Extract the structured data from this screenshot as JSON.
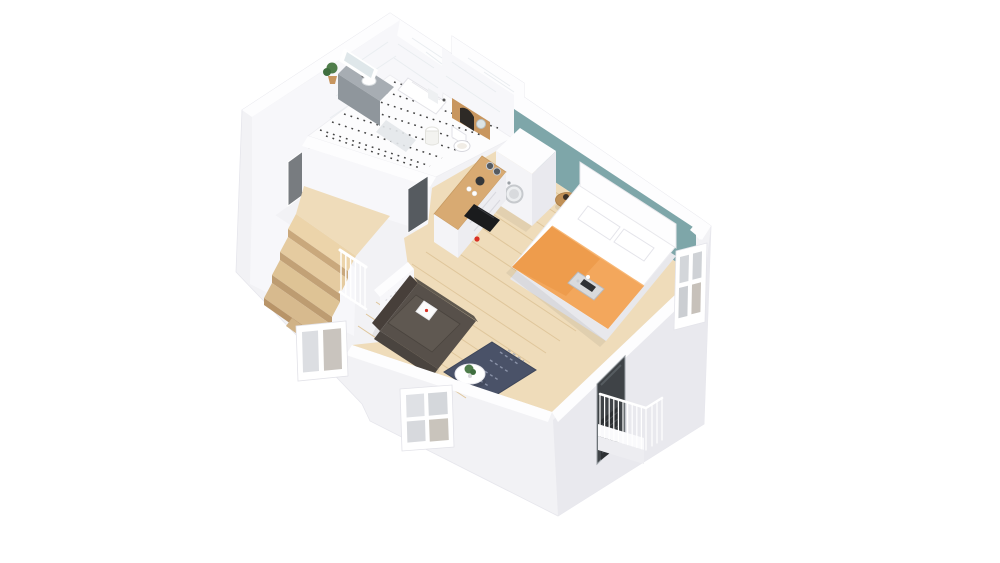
{
  "scene": {
    "kind": "3d-floor-plan-render",
    "view": "isometric dollhouse cutaway of a studio apartment, viewed from above",
    "background": "#ffffff"
  },
  "colors": {
    "wall_white": "#fdfdfe",
    "wall_light": "#f2f2f5",
    "wall_face": "#f7f7fa",
    "wall_shade": "#e9e9ee",
    "teal_wall": "#7ea6a9",
    "wood_floor": "#efdcba",
    "plank_line": "#dfc69b",
    "counter_wood": "#d8aa72",
    "niche_wood": "#c8965f",
    "table_wood": "#c09056",
    "stair_wood": "#e8cfa5",
    "stair_riser": "#c9a87c",
    "duvet_orange": "#f3a75c",
    "duvet_fold": "#e99440",
    "mattress_white": "#ffffff",
    "sofa_body": "#57504a",
    "sofa_seat": "#5f5851",
    "sofa_dark": "#473f3a",
    "rug_navy": "#4a5268",
    "rug_pattern": "#9aa2b8",
    "red_accent": "#d93025",
    "cooktop_black": "#1a1b1d",
    "door_gray": "#787c80",
    "door_dark": "#565b60",
    "balcony_door": "#3f4347",
    "glass_gray": "#d4d7db",
    "vanity_top": "#a7adb3",
    "vanity_front": "#8f969c",
    "plant_green": "#4f7d4b",
    "tile_dot": "#222222"
  },
  "rooms": [
    {
      "name": "bathroom",
      "floor": "black-and-white dotted tile"
    },
    {
      "name": "hallway-with-stairs",
      "floor": "wood"
    },
    {
      "name": "kitchen-nook",
      "floor": "wood"
    },
    {
      "name": "bedroom-living-room",
      "floor": "wood",
      "accent_wall": "#7ea6a9"
    },
    {
      "name": "balcony",
      "railing": "white"
    }
  ],
  "furniture": [
    "vanity-sink",
    "mirror",
    "potted-plant",
    "shower-tray",
    "toilet",
    "laundry-basket",
    "entry-door",
    "bathroom-door",
    "staircase",
    "stair-railing",
    "kitchen-counter",
    "cooktop",
    "kettle",
    "wardrobe",
    "washing-machine",
    "double-bed",
    "headboard",
    "pillows",
    "orange-duvet",
    "breakfast-tray",
    "side-table",
    "sofa",
    "sofa-pillow",
    "area-rug",
    "coffee-table",
    "window-left",
    "window-front",
    "window-right",
    "balcony-door",
    "balcony-railing",
    "radiator"
  ]
}
